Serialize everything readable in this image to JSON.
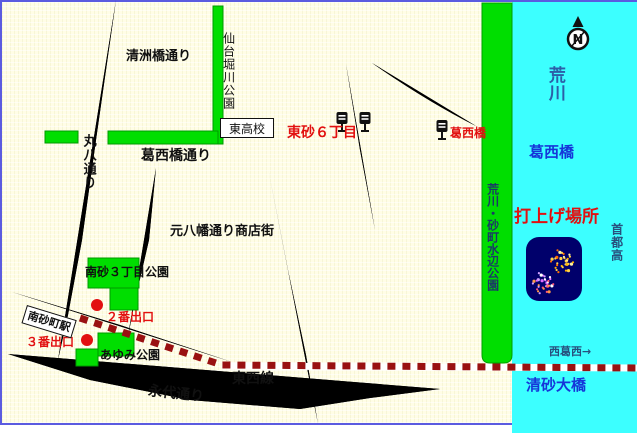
{
  "labels": {
    "kiyosubashi_dori": "清洲橋通り",
    "sendaibori_park": "仙台堀川公園",
    "higashi_highschool": "東高校",
    "higashisuna_6chome": "東砂６丁目",
    "kasaibashi_busstop": "葛西橋",
    "arakawa_river": "荒川",
    "kasaibashi_bridge": "葛西橋",
    "kasaibashi_dori": "葛西橋通り",
    "maruhachi_dori": "丸八通り",
    "motohachiman_shotengai": "元八幡通り商店街",
    "mizube_park": "荒川・砂町水辺公園",
    "launch_site": "打上げ場所",
    "shutoko": "首都高",
    "minamisuna_3chome_park": "南砂３丁目公園",
    "exit_2": "２番出口",
    "exit_3": "３番出口",
    "minamisuna_station": "南砂町駅",
    "ayumi_park": "あゆみ公園",
    "tozai_line": "東西線",
    "eitai_dori": "永代通り",
    "nishikasai_arrow": "西葛西→",
    "kiyosuna_ohashi": "清砂大橋",
    "compass_n": "N"
  },
  "colors": {
    "background_cream": "#FFFDE6",
    "park_green": "#00DE00",
    "river_cyan": "#3CFFFF",
    "road_gray": "#C9C9C9",
    "road_edge_gray": "#8F8F8F",
    "red_label": "#E21010",
    "blue_bridge_label": "#1636D9",
    "dark_blue_label": "#28507E",
    "rail_dash_red": "#991111",
    "map_border_blue": "#5B5BE0",
    "fireworks_navy": "#00006B"
  }
}
